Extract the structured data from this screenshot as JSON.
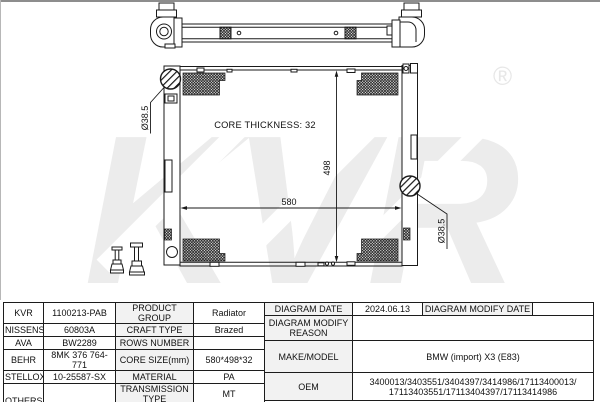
{
  "page": {
    "line_color": "#1a1a1a",
    "label_cell_bg": "#f2f2f2",
    "watermark_color": "#ececec"
  },
  "drawing": {
    "watermark_text": "KVR",
    "registered_symbol": "®",
    "core_thickness_label": "CORE THICKNESS: 32",
    "width_dimension": "580",
    "height_dimension": "498",
    "left_port_diameter": "Ø38.5",
    "right_port_diameter": "Ø38.5"
  },
  "spec_table": {
    "rows": [
      {
        "brand": "KVR",
        "number": "1100213-PAB",
        "property": "PRODUCT GROUP",
        "value": "Radiator"
      },
      {
        "brand": "NISSENS",
        "number": "60803A",
        "property": "CRAFT TYPE",
        "value": "Brazed"
      },
      {
        "brand": "AVA",
        "number": "BW2289",
        "property": "ROWS NUMBER",
        "value": ""
      },
      {
        "brand": "BEHR",
        "number": "8MK 376 764-771",
        "property": "CORE SIZE(mm)",
        "value": "580*498*32"
      },
      {
        "brand": "STELLOX",
        "number": "10-25587-SX",
        "property": "MATERIAL",
        "value": "PA"
      },
      {
        "brand": "OTHERS",
        "number": "",
        "property": "TRANSMISSION TYPE",
        "value": "MT"
      },
      {
        "property": "SUPPLEMENTARY",
        "value": ""
      }
    ]
  },
  "info_table": {
    "diagram_date_label": "DIAGRAM DATE",
    "diagram_date_value": "2024.06.13",
    "diagram_modify_date_label": "DIAGRAM MODIFY DATE",
    "diagram_modify_date_value": "",
    "diagram_modify_reason_label": "DIAGRAM MODIFY REASON",
    "diagram_modify_reason_value": "",
    "make_model_label": "MAKE/MODEL",
    "make_model_value": "BMW (import) X3 (E83)",
    "oem_label": "OEM",
    "oem_value_line1": "3400013/3403551/3404397/3414986/17113400013/",
    "oem_value_line2": "17113403551/17113404397/17113414986"
  }
}
